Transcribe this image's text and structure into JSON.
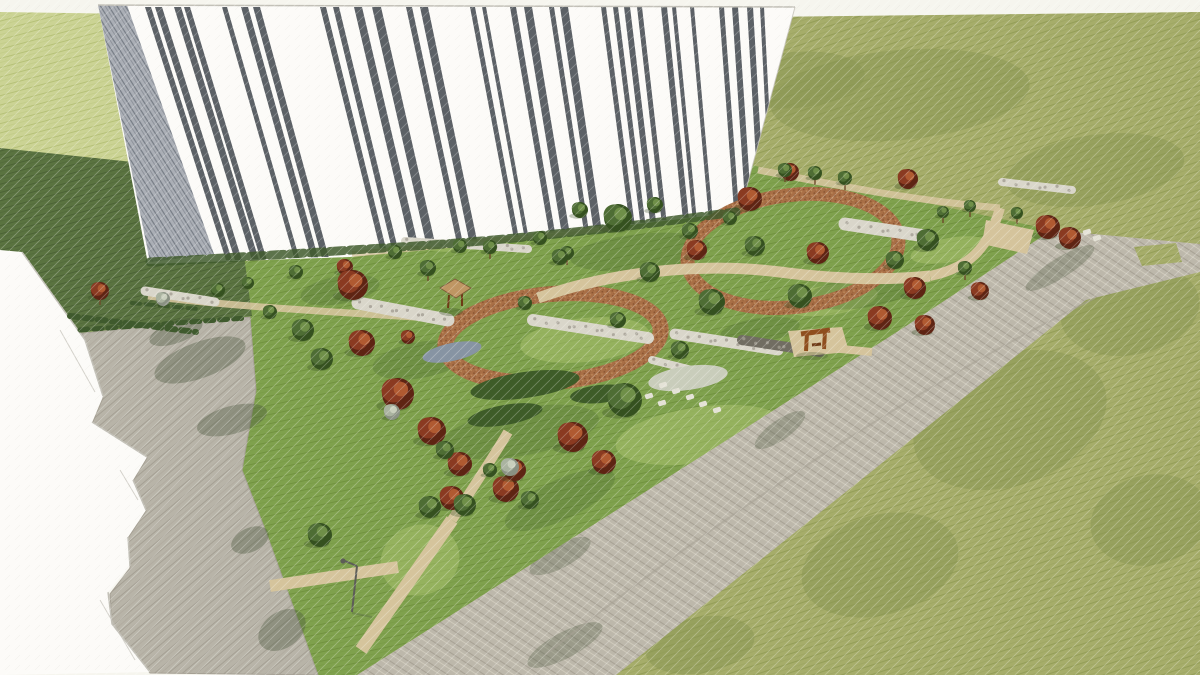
{
  "palette": {
    "paper": "#f6f5ee",
    "lawn-olive": "#a6ad6a",
    "lawn-olive-line": "#949e58",
    "lawn-olive-dk": "#8b9754",
    "lawn-light": "#cbd394",
    "lawn-light-line": "#b6c178",
    "lawn-dark": "#5a7340",
    "lawn-dark-line": "#4c6336",
    "park": "#7fa14d",
    "park-line": "#71923f",
    "park-sun": "#abc470",
    "park-shade": "#4d6d33",
    "road": "#bdb8ab",
    "road-line": "#a8a295",
    "road-line2": "#cfcabc",
    "plaza": "#b8b4a8",
    "plaza-line": "#a5a094",
    "brick": "#a96f46",
    "brick-d": "#8a5531",
    "brick-l": "#c08e5f",
    "tan": "#d5c49c",
    "tan-edge": "#b9a77f",
    "gravel": "#d9d6ca",
    "gravel-dark": "#716d62",
    "gravel-speck": "#a29e92",
    "stone": "#e4e2d6",
    "facade": "#fcfbf8",
    "facade-line": "#c3c1b8",
    "stripe": "#3f454c",
    "wall-base": "#abafb6",
    "wall-line": "#767c85",
    "hard-shadow": "#4b5a40",
    "tree-shadow": "#33491f",
    "trunk": "#6d4b2a",
    "hedge": "#3f5a2d",
    "bed-dark": "#3e5c28",
    "bed-white": "#c9cdbb",
    "bed-blue": "#8794a3",
    "corten": "#8f4e1e",
    "corten-d": "#6e3a15",
    "lamp": "#5d5d57"
  },
  "tree_colors": {
    "red": [
      "#5e2413",
      "#8a3a21",
      "#b05a31"
    ],
    "green": [
      "#35511f",
      "#4e6d34",
      "#6f8f48"
    ],
    "gray": [
      "#8a9183",
      "#aab3a0",
      "#c9cfbd"
    ]
  },
  "building": {
    "window_stripes": [
      [
        145,
        6
      ],
      [
        155,
        7
      ],
      [
        174,
        7
      ],
      [
        184,
        6
      ],
      [
        222,
        5
      ],
      [
        241,
        7
      ],
      [
        253,
        7
      ],
      [
        320,
        6
      ],
      [
        333,
        6
      ],
      [
        354,
        8
      ],
      [
        372,
        9
      ],
      [
        406,
        6
      ],
      [
        420,
        8
      ],
      [
        470,
        5
      ],
      [
        482,
        4
      ],
      [
        510,
        6
      ],
      [
        524,
        8
      ],
      [
        549,
        5
      ],
      [
        560,
        8
      ],
      [
        601,
        5
      ],
      [
        613,
        5
      ],
      [
        624,
        6
      ],
      [
        637,
        5
      ],
      [
        661,
        6
      ],
      [
        672,
        4
      ],
      [
        690,
        4
      ],
      [
        719,
        5
      ],
      [
        732,
        6
      ],
      [
        747,
        6
      ],
      [
        760,
        4
      ]
    ]
  },
  "trees": [
    [
      100,
      291,
      9,
      "red",
      1
    ],
    [
      345,
      267,
      8,
      "red",
      0
    ],
    [
      353,
      285,
      15,
      "red",
      0
    ],
    [
      362,
      343,
      13,
      "red",
      0
    ],
    [
      398,
      394,
      16,
      "red",
      0
    ],
    [
      432,
      431,
      14,
      "red",
      0
    ],
    [
      460,
      464,
      12,
      "red",
      0
    ],
    [
      506,
      489,
      13,
      "red",
      0
    ],
    [
      452,
      498,
      12,
      "red",
      0
    ],
    [
      573,
      437,
      15,
      "red",
      0
    ],
    [
      604,
      462,
      12,
      "red",
      0
    ],
    [
      515,
      470,
      11,
      "red",
      0
    ],
    [
      408,
      337,
      7,
      "red",
      0
    ],
    [
      750,
      199,
      12,
      "red",
      0
    ],
    [
      790,
      172,
      9,
      "red",
      0
    ],
    [
      697,
      250,
      10,
      "red",
      0
    ],
    [
      818,
      253,
      11,
      "red",
      0
    ],
    [
      908,
      179,
      10,
      "red",
      0
    ],
    [
      915,
      288,
      11,
      "red",
      0
    ],
    [
      980,
      291,
      9,
      "red",
      0
    ],
    [
      880,
      318,
      12,
      "red",
      0
    ],
    [
      925,
      325,
      10,
      "red",
      0
    ],
    [
      1048,
      227,
      12,
      "red",
      0
    ],
    [
      1070,
      238,
      11,
      "red",
      0
    ],
    [
      428,
      268,
      8,
      "green",
      1
    ],
    [
      490,
      247,
      7,
      "green",
      1
    ],
    [
      567,
      253,
      7,
      "green",
      1
    ],
    [
      618,
      218,
      14,
      "green",
      0
    ],
    [
      650,
      272,
      10,
      "green",
      0
    ],
    [
      712,
      302,
      13,
      "green",
      0
    ],
    [
      800,
      296,
      12,
      "green",
      0
    ],
    [
      755,
      246,
      10,
      "green",
      0
    ],
    [
      690,
      231,
      8,
      "green",
      0
    ],
    [
      560,
      257,
      8,
      "green",
      0
    ],
    [
      525,
      303,
      7,
      "green",
      0
    ],
    [
      303,
      330,
      11,
      "green",
      0
    ],
    [
      322,
      359,
      11,
      "green",
      0
    ],
    [
      270,
      312,
      7,
      "green",
      0
    ],
    [
      445,
      450,
      9,
      "green",
      0
    ],
    [
      490,
      470,
      7,
      "green",
      0
    ],
    [
      530,
      500,
      9,
      "green",
      0
    ],
    [
      625,
      400,
      17,
      "green",
      0
    ],
    [
      680,
      350,
      9,
      "green",
      0
    ],
    [
      430,
      507,
      11,
      "green",
      0
    ],
    [
      320,
      535,
      12,
      "green",
      0
    ],
    [
      465,
      505,
      11,
      "green",
      0
    ],
    [
      928,
      240,
      11,
      "green",
      0
    ],
    [
      895,
      260,
      9,
      "green",
      0
    ],
    [
      965,
      268,
      7,
      "green",
      1
    ],
    [
      943,
      212,
      6,
      "green",
      1
    ],
    [
      970,
      206,
      6,
      "green",
      1
    ],
    [
      1017,
      213,
      6,
      "green",
      1
    ],
    [
      618,
      320,
      8,
      "green",
      0
    ],
    [
      580,
      210,
      8,
      "green",
      0
    ],
    [
      655,
      205,
      8,
      "green",
      0
    ],
    [
      730,
      218,
      7,
      "green",
      0
    ],
    [
      785,
      170,
      7,
      "green",
      1
    ],
    [
      815,
      173,
      7,
      "green",
      1
    ],
    [
      845,
      178,
      7,
      "green",
      1
    ],
    [
      395,
      252,
      7,
      "green",
      0
    ],
    [
      460,
      246,
      7,
      "green",
      0
    ],
    [
      540,
      238,
      7,
      "green",
      0
    ],
    [
      218,
      290,
      7,
      "green",
      0
    ],
    [
      248,
      283,
      6,
      "green",
      0
    ],
    [
      296,
      272,
      7,
      "green",
      0
    ],
    [
      510,
      467,
      9,
      "gray",
      0
    ],
    [
      392,
      412,
      8,
      "gray",
      0
    ],
    [
      163,
      299,
      7,
      "gray",
      0
    ]
  ],
  "beds": [
    [
      525,
      385,
      55,
      13,
      -8,
      "dark"
    ],
    [
      505,
      415,
      38,
      10,
      -10,
      "dark"
    ],
    [
      688,
      378,
      40,
      12,
      -8,
      "white"
    ],
    [
      452,
      352,
      30,
      9,
      -12,
      "blue"
    ],
    [
      600,
      394,
      30,
      9,
      -6,
      "dark"
    ]
  ],
  "gravel_strips": [
    [
      358,
      303,
      448,
      320,
      13,
      "light"
    ],
    [
      533,
      320,
      648,
      338,
      12,
      "light"
    ],
    [
      845,
      224,
      925,
      236,
      13,
      "light"
    ],
    [
      675,
      334,
      778,
      350,
      11,
      "light"
    ],
    [
      145,
      291,
      215,
      302,
      9,
      "light"
    ],
    [
      405,
      241,
      528,
      249,
      8,
      "light"
    ],
    [
      1002,
      182,
      1072,
      190,
      8,
      "light"
    ],
    [
      742,
      340,
      820,
      352,
      10,
      "dark"
    ],
    [
      652,
      360,
      700,
      372,
      8,
      "light"
    ]
  ],
  "stepping_stones": [
    [
      663,
      385
    ],
    [
      676,
      391
    ],
    [
      690,
      397
    ],
    [
      703,
      404
    ],
    [
      662,
      403
    ],
    [
      649,
      396
    ],
    [
      717,
      410
    ],
    [
      1087,
      232
    ],
    [
      1097,
      238
    ]
  ],
  "hedges": [
    [
      70,
      316,
      196,
      332,
      6
    ],
    [
      132,
      303,
      198,
      309,
      4
    ],
    [
      80,
      330,
      246,
      318,
      5
    ]
  ],
  "sun_patches": [
    [
      585,
      340,
      65,
      22,
      -6
    ],
    [
      700,
      435,
      85,
      28,
      -8
    ],
    [
      470,
      235,
      55,
      15,
      -8
    ],
    [
      830,
      300,
      48,
      15,
      -8
    ],
    [
      950,
      250,
      40,
      12,
      -10
    ],
    [
      420,
      560,
      40,
      35,
      -20
    ]
  ],
  "shade_patches": [
    [
      640,
      252,
      70,
      18,
      -6
    ],
    [
      520,
      432,
      80,
      24,
      -10
    ],
    [
      862,
      292,
      55,
      16,
      -8
    ],
    [
      420,
      360,
      48,
      18,
      -10
    ],
    [
      560,
      500,
      60,
      20,
      -25
    ],
    [
      760,
      330,
      40,
      12,
      -8
    ],
    [
      340,
      290,
      40,
      14,
      -10
    ]
  ],
  "lawn_mottles": [
    [
      900,
      95,
      130,
      45,
      -5
    ],
    [
      1095,
      170,
      90,
      35,
      -8
    ],
    [
      1010,
      420,
      100,
      65,
      -20
    ],
    [
      880,
      565,
      80,
      50,
      -15
    ],
    [
      1130,
      310,
      70,
      45,
      -10
    ],
    [
      700,
      645,
      55,
      28,
      -10
    ],
    [
      1150,
      520,
      60,
      45,
      -12
    ],
    [
      795,
      80,
      70,
      28,
      -5
    ]
  ],
  "plaza_shadows": [
    [
      200,
      360,
      48,
      18,
      -20
    ],
    [
      232,
      420,
      36,
      14,
      -15
    ],
    [
      176,
      332,
      28,
      11,
      -20
    ],
    [
      282,
      630,
      26,
      18,
      -35
    ],
    [
      250,
      540,
      20,
      12,
      -25
    ]
  ],
  "road_shadows": [
    [
      420,
      600,
      55,
      16,
      -28
    ],
    [
      560,
      556,
      34,
      12,
      -28
    ],
    [
      565,
      645,
      42,
      13,
      -28
    ],
    [
      780,
      430,
      30,
      10,
      -35
    ],
    [
      1060,
      268,
      40,
      10,
      -32
    ]
  ]
}
